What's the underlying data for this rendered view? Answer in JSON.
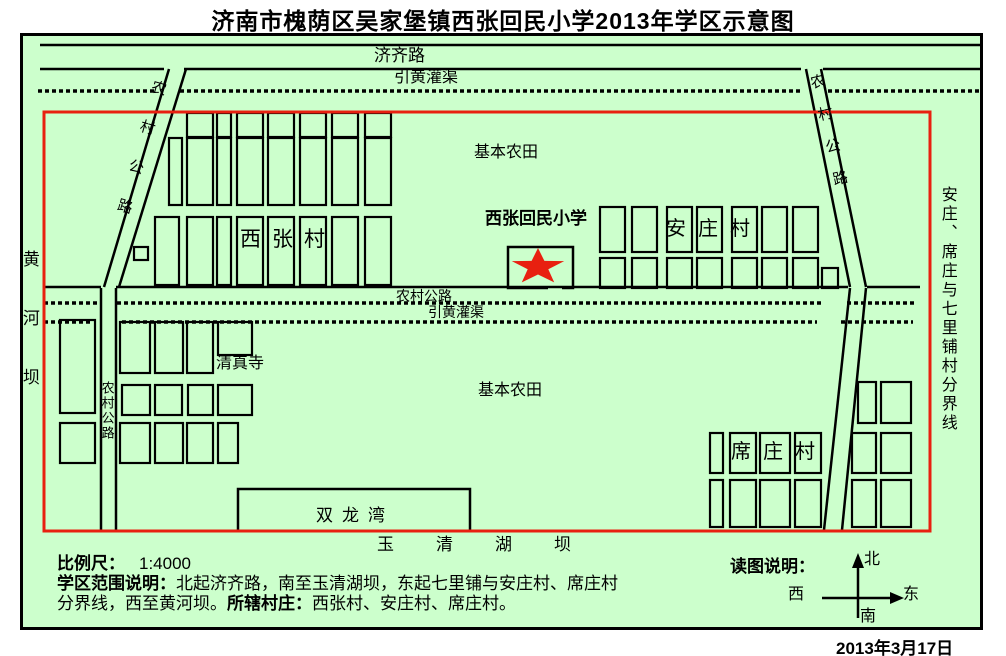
{
  "title": "济南市槐荫区吴家堡镇西张回民小学2013年学区示意图",
  "date": "2013年3月17日",
  "colors": {
    "background": "#ccffcc",
    "line": "#000000",
    "boundary_red": "#e82010",
    "star_red": "#e82010"
  },
  "map": {
    "labels": {
      "jiqi_road": "济齐路",
      "canal_top": "引黄灌渠",
      "farmland_top": "基本农田",
      "school": "西张回民小学",
      "anzhuang_village": "安庄村",
      "xizhang_village": "西张村",
      "rural_road_mid": "农村公路",
      "canal_mid": "引黄灌渠",
      "mosque": "清真寺",
      "farmland_bottom": "基本农田",
      "xizhuang_village": "席庄村",
      "shuanglongwan": "双龙湾",
      "yuqinghu_dam": "玉清湖坝",
      "huanghe_dam": "黄河坝",
      "rural_road_left_vertical": "农村公路",
      "rural_road_left_diagonal": "农村公路",
      "rural_road_right_diagonal": "农村公路",
      "east_boundary_note": "安庄、席庄与七里铺村分界线"
    },
    "geometry": {
      "solid_lines": [
        [
          40,
          45,
          983,
          45
        ],
        [
          40,
          69,
          164,
          69
        ],
        [
          184,
          69,
          801,
          69
        ],
        [
          823,
          69,
          983,
          69
        ],
        [
          44,
          287,
          101,
          287
        ],
        [
          116,
          287,
          848,
          287
        ],
        [
          867,
          287,
          920,
          287
        ],
        [
          101,
          288,
          101,
          530
        ],
        [
          116,
          288,
          116,
          530
        ],
        [
          169,
          69,
          104,
          287
        ],
        [
          186,
          69,
          119,
          287
        ],
        [
          806,
          69,
          850,
          287
        ],
        [
          821,
          69,
          866,
          287
        ],
        [
          850,
          288,
          824,
          530
        ],
        [
          866,
          288,
          842,
          530
        ]
      ],
      "dotted_lines": [
        [
          38,
          91,
          155,
          91
        ],
        [
          180,
          91,
          801,
          91
        ],
        [
          828,
          91,
          983,
          91
        ],
        [
          44,
          303,
          100,
          303
        ],
        [
          117,
          303,
          822,
          303
        ],
        [
          847,
          303,
          916,
          303
        ],
        [
          44,
          322,
          92,
          322
        ],
        [
          122,
          322,
          817,
          322
        ],
        [
          841,
          322,
          913,
          322
        ]
      ],
      "red_boundary": {
        "x": 44,
        "y": 112,
        "w": 886,
        "h": 419
      },
      "school_outline": "M548 288 H508 V247 H573 V288 H562",
      "shuanglongwan_outline": "M238 531 V489 H470 V531",
      "star": {
        "cx": 538,
        "cy": 267,
        "outer_r": 19,
        "inner_r": 7.5,
        "x_scale": 1.45
      },
      "villages": {
        "xizhang": [
          [
            187,
            113,
            26,
            24
          ],
          [
            217,
            113,
            14,
            24
          ],
          [
            237,
            113,
            26,
            24
          ],
          [
            268,
            113,
            26,
            24
          ],
          [
            300,
            113,
            26,
            24
          ],
          [
            332,
            113,
            26,
            24
          ],
          [
            365,
            113,
            26,
            24
          ],
          [
            169,
            138,
            13,
            67
          ],
          [
            187,
            138,
            26,
            67
          ],
          [
            217,
            138,
            14,
            67
          ],
          [
            237,
            138,
            26,
            67
          ],
          [
            268,
            138,
            26,
            67
          ],
          [
            300,
            138,
            26,
            67
          ],
          [
            332,
            138,
            26,
            67
          ],
          [
            365,
            138,
            26,
            67
          ],
          [
            155,
            217,
            24,
            68
          ],
          [
            187,
            217,
            26,
            68
          ],
          [
            217,
            217,
            14,
            68
          ],
          [
            237,
            217,
            26,
            68
          ],
          [
            268,
            217,
            26,
            68
          ],
          [
            300,
            217,
            26,
            68
          ],
          [
            332,
            217,
            26,
            68
          ],
          [
            365,
            217,
            26,
            68
          ],
          [
            134,
            247,
            14,
            13
          ]
        ],
        "anzhuang": [
          [
            600,
            207,
            25,
            45
          ],
          [
            632,
            207,
            25,
            45
          ],
          [
            667,
            207,
            25,
            45
          ],
          [
            697,
            207,
            25,
            45
          ],
          [
            732,
            207,
            25,
            45
          ],
          [
            762,
            207,
            25,
            45
          ],
          [
            793,
            207,
            25,
            45
          ],
          [
            600,
            258,
            25,
            30
          ],
          [
            632,
            258,
            25,
            30
          ],
          [
            667,
            258,
            25,
            30
          ],
          [
            697,
            258,
            25,
            30
          ],
          [
            732,
            258,
            25,
            30
          ],
          [
            762,
            258,
            25,
            30
          ],
          [
            793,
            258,
            25,
            30
          ],
          [
            822,
            268,
            16,
            20
          ]
        ],
        "mosque_block": [
          [
            60,
            320,
            35,
            93
          ],
          [
            60,
            423,
            35,
            40
          ],
          [
            120,
            322,
            30,
            51
          ],
          [
            155,
            322,
            28,
            51
          ],
          [
            187,
            322,
            26,
            51
          ],
          [
            218,
            322,
            34,
            33
          ],
          [
            122,
            385,
            28,
            30
          ],
          [
            155,
            385,
            27,
            30
          ],
          [
            188,
            385,
            25,
            30
          ],
          [
            218,
            385,
            34,
            30
          ],
          [
            120,
            423,
            30,
            40
          ],
          [
            155,
            423,
            28,
            40
          ],
          [
            187,
            423,
            26,
            40
          ],
          [
            218,
            423,
            20,
            40
          ]
        ],
        "xizhuang": [
          [
            858,
            382,
            18,
            41
          ],
          [
            881,
            382,
            30,
            41
          ],
          [
            710,
            433,
            13,
            40
          ],
          [
            730,
            433,
            26,
            40
          ],
          [
            760,
            433,
            30,
            40
          ],
          [
            795,
            433,
            26,
            40
          ],
          [
            852,
            433,
            24,
            40
          ],
          [
            881,
            433,
            30,
            40
          ],
          [
            710,
            480,
            13,
            47
          ],
          [
            730,
            480,
            26,
            47
          ],
          [
            760,
            480,
            30,
            47
          ],
          [
            795,
            480,
            26,
            47
          ],
          [
            852,
            480,
            24,
            47
          ],
          [
            881,
            480,
            30,
            47
          ]
        ]
      },
      "compass": {
        "lines": [
          [
            858,
            562,
            858,
            618
          ],
          [
            822,
            598,
            896,
            598
          ]
        ],
        "arrows": [
          [
            858,
            553,
            852,
            568,
            864,
            568
          ],
          [
            904,
            598,
            890,
            592,
            890,
            604
          ]
        ]
      }
    }
  },
  "legend": {
    "title": "读图说明：",
    "north": "北",
    "south": "南",
    "east": "东",
    "west": "西"
  },
  "notes": {
    "scale_label": "比例尺：",
    "scale_value": "1:4000",
    "scope_label": "学区范围说明：",
    "scope_text_line1": "北起济齐路，南至玉清湖坝，东起七里铺与安庄村、席庄村",
    "scope_text_line2": "分界线，西至黄河坝。",
    "villages_label": "所辖村庄：",
    "villages_text": "西张村、安庄村、席庄村。"
  }
}
